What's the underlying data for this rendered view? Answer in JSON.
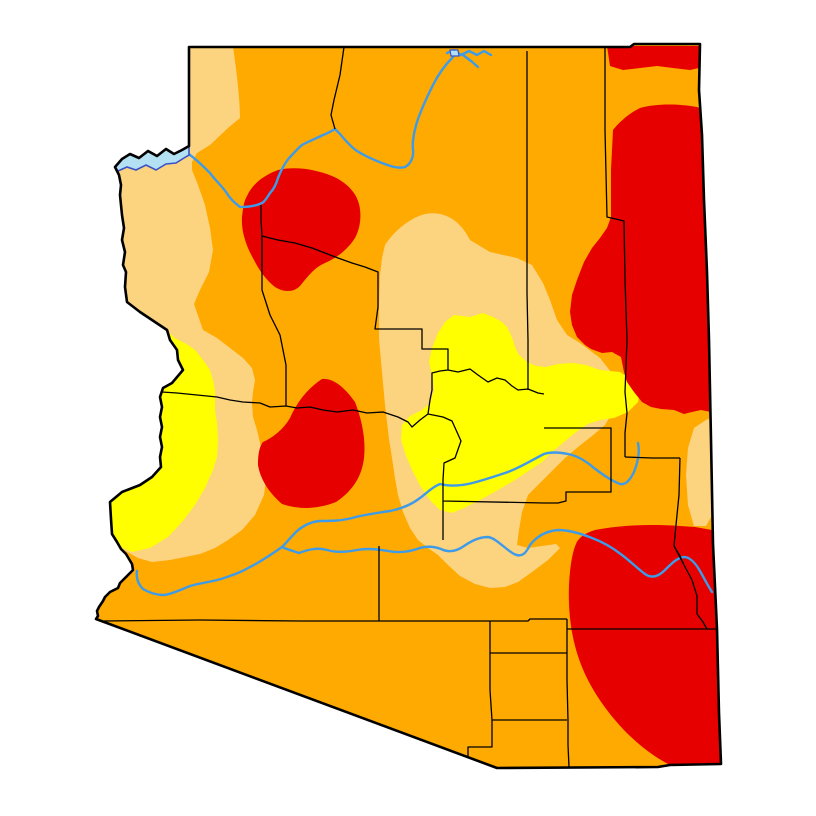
{
  "map": {
    "name": "arizona-drought-severity-map",
    "canvas": {
      "width": 816,
      "height": 816,
      "background": "#FFFFFF"
    },
    "palette": {
      "abnormally_dry_yellow": "#FFFF00",
      "moderate_drought_tan": "#FCD37F",
      "severe_drought_orange": "#FFAA00",
      "extreme_drought_red": "#E60000",
      "river_blue": "#3D9BE9",
      "lake_fill_blue": "#B3E0F2",
      "lake_edge_blue": "#3A52C8",
      "boundary_black": "#000000"
    },
    "state_outline": {
      "stroke": "#000000",
      "stroke_width": 2.6,
      "d": "M 189,47 L 630,47 L 634,44 L 700,44 L 699,90 L 702,135 L 704,200 L 707,272 L 709,340 L 711,440 L 713,544 L 717,629 L 719,713 L 721,764 L 670,765 L 658,767 L 497,768 L 96,619 L 98,616 L 97,611 L 99,607 L 103,601 L 105,597 L 110,592 L 118,588 L 120,583 L 123,580 L 128,575 L 133,570 L 132,564 L 129,559 L 126,554 L 121,549 L 117,542 L 112,534 L 111,519 L 110,502 L 122,492 L 140,485 L 152,477 L 161,467 L 160,457 L 162,447 L 160,437 L 162,427 L 160,417 L 162,407 L 160,397 L 162,391 L 163,388 L 172,383 L 183,370 L 178,360 L 177,350 L 170,340 L 167,330 L 155,322 L 140,312 L 127,302 L 125,287 L 126,272 L 123,265 L 125,252 L 122,240 L 124,228 L 122,215 L 120,195 L 121,185 L 119,175 L 115,167 L 122,159 L 130,154 L 139,158 L 148,151 L 157,156 L 166,149 L 174,154 L 182,150 L 189,146 Z"
    },
    "drought_regions": [
      {
        "name": "severe-drought-base",
        "fill": "#FFAA00",
        "d": "M 189,47 L 630,47 L 634,44 L 700,44 L 699,90 L 702,135 L 704,200 L 707,272 L 709,340 L 711,440 L 713,544 L 717,629 L 719,713 L 721,764 L 670,765 L 658,767 L 497,768 L 96,619 L 98,616 L 97,611 L 99,607 L 103,601 L 105,597 L 110,592 L 118,588 L 120,583 L 123,580 L 128,575 L 133,570 L 132,564 L 129,559 L 126,554 L 121,549 L 117,542 L 112,534 L 111,519 L 110,502 L 122,492 L 140,485 L 152,477 L 161,467 L 160,457 L 162,447 L 160,437 L 162,427 L 160,417 L 162,407 L 160,397 L 162,391 L 163,388 L 172,383 L 183,370 L 178,360 L 177,350 L 170,340 L 167,330 L 155,322 L 140,312 L 127,302 L 125,287 L 126,272 L 123,265 L 125,252 L 122,240 L 124,228 L 122,215 L 120,195 L 121,185 L 119,175 L 115,167 L 122,159 L 130,154 L 139,158 L 148,151 L 157,156 L 166,149 L 174,154 L 182,150 L 189,146 Z"
      },
      {
        "name": "moderate-drought-west-band",
        "fill": "#FCD37F",
        "d": "M 233,47 C 238,80 240,105 240,118 L 228,128 L 210,145 L 197,153 L 192,162 L 192,170 L 198,185 L 205,205 L 210,228 L 213,250 L 209,272 L 200,290 L 194,304 L 203,330 L 217,338 L 230,348 L 243,358 L 252,368 L 255,380 L 253,392 L 252,403 L 253,417 L 257,430 L 260,443 L 263,457 L 267,470 L 264,495 L 255,515 L 242,530 L 228,540 L 215,548 L 200,554 L 185,557 L 170,560 L 152,562 L 138,558 L 124,550 L 110,540 L 78,522 L 78,40 L 189,40 Z"
      },
      {
        "name": "abnormally-dry-west-band",
        "fill": "#FFFF00",
        "d": "M 140,312 L 160,325 L 175,338 L 188,345 L 195,350 L 203,360 L 210,370 L 213,380 L 215,390 L 215,410 L 217,423 L 218,440 L 217,457 L 213,470 L 205,488 L 195,505 L 182,522 L 168,537 L 150,548 L 132,552 L 118,546 L 108,536 L 104,515 L 104,480 L 112,450 L 118,410 L 124,370 L 128,338 Z"
      },
      {
        "name": "moderate-drought-center-region",
        "fill": "#FCD37F",
        "d": "M 385,245 C 395,230 410,218 425,214 C 440,211 458,216 470,240 L 490,252 L 517,258 L 532,265 L 543,283 L 550,300 L 557,320 L 567,335 L 580,343 L 600,358 L 611,372 L 618,390 L 614,410 L 605,425 L 592,436 L 578,447 L 565,458 L 553,470 L 540,483 L 528,495 L 522,512 L 519,530 L 517,545 L 528,548 L 542,546 L 556,544 L 560,548 L 548,560 L 532,572 L 518,582 L 505,587 L 490,588 L 475,584 L 460,576 L 448,565 L 438,555 L 428,548 L 418,540 L 410,528 L 403,512 L 398,495 L 395,478 L 392,458 L 389,439 L 385,405 L 382,372 L 379,339 L 379,305 L 380,275 L 382,258 Z"
      },
      {
        "name": "abnormally-dry-center-region",
        "fill": "#FFFF00",
        "d": "M 454,315 L 470,317 L 483,313 L 493,317 L 502,322 L 507,327 L 510,333 L 513,340 L 515,347 L 519,355 L 527,362 L 536,366 L 546,367 L 558,364 L 572,363 L 586,365 L 600,370 L 620,372 L 632,380 L 640,390 L 638,402 L 628,412 L 614,418 L 600,420 L 588,424 L 576,432 L 564,442 L 552,452 L 542,462 L 530,470 L 515,480 L 498,490 L 480,500 L 464,508 L 452,513 L 440,510 L 430,500 L 421,487 L 413,472 L 406,456 L 401,440 L 402,425 L 410,416 L 422,410 L 430,403 L 434,390 L 432,375 L 429,362 L 432,348 L 438,333 L 445,322 Z"
      },
      {
        "name": "moderate-drought-east-border-strip",
        "fill": "#FCD37F",
        "d": "M 694,428 L 706,420 L 716,416 L 718,440 L 718,480 L 715,510 L 706,526 L 694,526 L 688,505 L 686,475 L 688,448 Z"
      },
      {
        "name": "extreme-drought-northwest-blob",
        "fill": "#E60000",
        "d": "M 247,196 C 252,185 262,176 278,170 C 295,166 315,169 332,176 C 346,182 356,192 359,204 C 362,216 360,229 355,238 C 348,249 337,258 325,263 C 315,267 308,276 300,286 C 293,293 283,292 275,287 C 266,280 259,270 254,260 C 246,246 241,231 242,217 C 243,208 244,201 247,196 Z"
      },
      {
        "name": "extreme-drought-westcentral-blob",
        "fill": "#E60000",
        "d": "M 322,379 C 334,378 345,388 355,402 C 362,420 366,440 364,458 C 362,475 354,490 336,502 C 318,509 300,510 282,504 C 268,492 260,478 258,465 C 258,452 260,446 263,442 C 272,438 283,430 290,418 C 297,402 308,388 322,379 Z"
      },
      {
        "name": "extreme-drought-northeast-strip",
        "fill": "#E60000",
        "d": "M 607,46 L 699,46 L 699,68 L 690,70 L 673,68 L 657,66 L 640,68 L 623,70 L 610,66 Z"
      },
      {
        "name": "extreme-drought-east-region",
        "fill": "#E60000",
        "d": "M 613,130 C 620,121 630,113 640,108 C 658,103 680,104 697,107 L 704,110 L 707,272 L 711,412 L 701,410 L 692,412 L 684,414 L 674,410 L 661,409 L 651,407 L 642,402 L 634,392 L 627,382 L 624,372 L 621,357 L 612,352 L 602,353 L 591,349 L 585,345 L 577,337 L 572,325 L 570,312 L 572,295 L 577,280 L 584,262 L 592,248 L 600,238 L 607,228 L 611,217 L 611,170 Z"
      },
      {
        "name": "extreme-drought-southeast-region",
        "fill": "#E60000",
        "d": "M 576,544 C 578,538 585,533 595,530 C 620,525 650,524 680,526 L 695,527 L 712,530 L 716,600 L 718,680 L 721,764 L 670,765 C 650,755 630,738 615,720 C 598,700 585,678 578,656 C 571,635 568,610 569,585 C 570,568 572,553 576,544 Z"
      }
    ],
    "county_lines": {
      "stroke": "#000000",
      "stroke_width": 1.3,
      "paths": [
        {
          "name": "county-line-coconino-mohave-north",
          "d": "M 344,47 L 340,75 L 334,100 L 331,115 L 335,129"
        },
        {
          "name": "county-line-coconino-navajo",
          "d": "M 527,51 L 527,200 L 527,293 L 528,340 L 528,390"
        },
        {
          "name": "county-line-navajo-apache",
          "d": "M 605,46 L 605,130 L 607,217 L 624,221 L 625,280 L 627,340 L 625,392 L 627,413 L 625,433 L 625,457"
        },
        {
          "name": "county-line-graham-north",
          "d": "M 625,457 L 652,458 L 680,458"
        },
        {
          "name": "county-line-greenlee-west",
          "d": "M 680,458 L 679,495 L 676,525 L 674,546 L 684,565 L 692,580 L 697,596 L 697,614 L 703,622 L 707,629"
        },
        {
          "name": "county-line-coconino-south",
          "d": "M 261,205 L 261,220 L 262,236 L 278,240 L 295,243 L 312,248 L 325,253 L 338,258 L 352,263 L 365,267 L 378,272 L 378,307 L 375,329 L 422,329 L 422,349 L 448,349 L 448,370"
        },
        {
          "name": "county-line-mohave-yavapai-south",
          "d": "M 262,236 L 262,290 L 270,315 L 280,335 L 286,365 L 286,406"
        },
        {
          "name": "county-line-lapaz-yavapai",
          "d": "M 162,392 L 177,393 L 197,395 L 217,397 L 230,400 L 243,402 L 260,403 L 270,407 L 286,406 L 297,408 L 310,407 L 323,410 L 337,412 L 353,410 L 367,413 L 383,412 L 398,417 L 408,422 L 412,427 L 420,420 L 428,414"
        },
        {
          "name": "county-line-mogollon-rim",
          "d": "M 448,370 L 440,371 L 432,373 L 432,390 L 430,400 L 428,414"
        },
        {
          "name": "county-line-gila-north",
          "d": "M 448,370 L 458,372 L 470,369 L 478,375 L 488,382 L 497,378 L 505,380 L 512,386 L 518,390 L 528,389 L 538,393 L 544,394"
        },
        {
          "name": "county-line-gila-maricopa-graham",
          "d": "M 428,414 L 443,417 L 452,421 L 461,441 L 455,458 L 444,463 L 443,480 L 443,501 L 544,503 L 558,503 L 566,501 L 566,492 L 590,492 L 611,492 L 611,460 L 611,428 L 575,428 L 544,428"
        },
        {
          "name": "county-line-pinal-west",
          "d": "M 443,501 L 443,540"
        },
        {
          "name": "county-line-pima-north",
          "d": "M 104,621 L 200,620 L 300,621 L 379,621 L 440,621 L 490,621 L 528,621 L 530,619 L 567,619"
        },
        {
          "name": "county-line-pinal-pima-west",
          "d": "M 379,546 L 379,585 L 379,621"
        },
        {
          "name": "county-line-santacruz-northwest",
          "d": "M 490,621 L 490,653 L 520,653 L 545,653 L 567,653"
        },
        {
          "name": "county-line-santacruz-west",
          "d": "M 490,653 L 490,690 L 492,720 L 530,720 L 567,720"
        },
        {
          "name": "county-line-santacruz-southwest",
          "d": "M 492,720 L 492,747 L 468,747 L 468,761"
        },
        {
          "name": "county-line-cochise-north",
          "d": "M 567,619 L 567,629 L 620,629 L 680,629 L 717,629"
        },
        {
          "name": "county-line-santacruz-cochise",
          "d": "M 567,629 L 567,680 L 568,720 L 568,745 L 569,767"
        },
        {
          "name": "county-line-greenlee-south-jag",
          "d": "M 674,546 L 680,556 L 684,565"
        }
      ]
    },
    "rivers": {
      "stroke": "#3D9BE9",
      "stroke_width": 2.4,
      "paths": [
        {
          "name": "river-colorado-grand-canyon",
          "d": "M 453,57 C 445,65 438,75 433,85 C 427,97 421,110 417,122 C 414,132 412,142 413,150 C 414,156 411,164 405,167 C 398,169 390,166 382,163 C 374,160 365,156 357,151 C 351,147 345,140 340,134 L 335,129 C 330,132 326,134 323,135 C 315,139 307,142 302,145 C 298,148 295,152 291,156 C 286,161 282,168 278,178 C 276,185 273,190 270,193 C 267,198 264,202 262,203 C 256,206 247,207 240,207 C 235,203 230,199 226,192 C 221,185 215,180 210,173 C 204,167 197,160 190,155 L 184,152"
        },
        {
          "name": "river-salt-black",
          "d": "M 638,443 C 640,452 638,462 634,472 C 630,480 626,485 620,484 C 610,480 602,474 594,468 C 586,461 578,456 568,454 C 558,452 550,452 544,454 C 532,460 518,469 505,473 C 490,478 478,482 468,484 C 458,486 448,486 440,484 C 432,487 427,493 420,498 C 411,505 400,509 390,511 C 376,513 362,515 352,518 C 341,521 330,521 319,521 C 310,522 303,526 297,531 C 291,537 286,543 282,547"
        },
        {
          "name": "river-gila-east",
          "d": "M 712,592 C 708,586 704,578 700,571 C 696,564 691,558 685,557 C 678,557 672,563 665,570 C 659,576 652,579 645,574 C 637,568 630,561 622,555 C 613,548 603,542 592,538 C 582,534 570,530 558,530 C 546,531 537,536 530,545 C 526,553 522,558 514,554 C 505,549 496,538 488,537 C 478,537 470,542 464,546 C 457,551 449,553 441,549 C 433,546 425,546 417,549 C 408,552 398,553 388,551 C 377,549 367,548 357,550 C 347,552 337,553 327,550 C 317,547 307,550 299,553 C 293,551 286,549 282,547"
        },
        {
          "name": "river-gila-west",
          "d": "M 282,547 C 272,554 260,562 250,567 C 240,573 230,576 221,579 C 211,582 200,583 190,586 C 180,590 172,594 164,595 C 156,595 148,592 143,589 C 138,584 136,578 137,571"
        },
        {
          "name": "river-lake-powell-squiggle",
          "d": "M 447,53 L 454,50 L 461,55 L 469,51 L 477,55 L 484,51 L 491,55"
        },
        {
          "name": "river-san-juan-arm",
          "d": "M 463,55 L 471,61 L 478,67"
        }
      ]
    },
    "lakes": [
      {
        "name": "lake-mead-mohave",
        "fill": "#B3E0F2",
        "stroke": "#3A52C8",
        "stroke_width": 1.6,
        "d": "M 189,146 L 182,150 L 174,154 L 166,149 L 157,156 L 148,151 L 139,158 L 130,154 L 122,159 L 114,166 L 118,171 L 127,167 L 136,170 L 146,165 L 156,170 L 166,164 L 176,163 L 184,158 L 189,155 Z"
      },
      {
        "name": "lake-powell-patch",
        "fill": "#B3E0F2",
        "stroke": "#3A52C8",
        "stroke_width": 1.2,
        "d": "M 450,50 L 458,50 L 459,56 L 451,56 Z"
      }
    ]
  }
}
